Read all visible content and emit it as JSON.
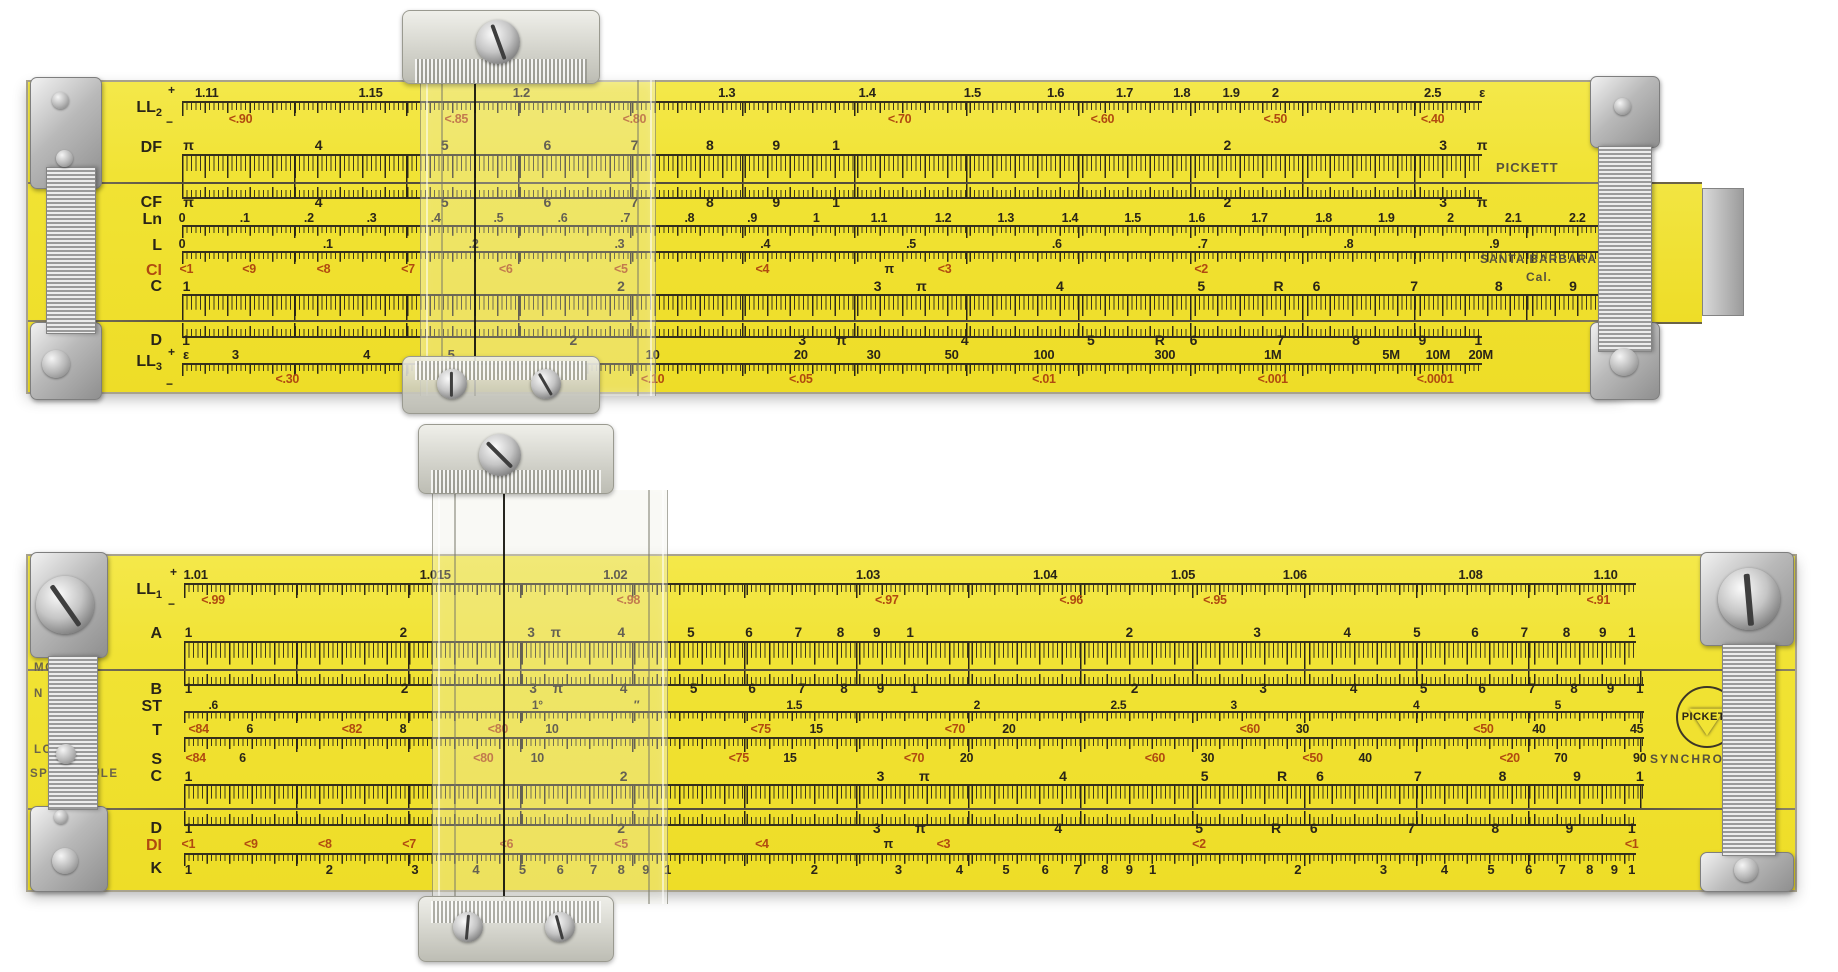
{
  "front": {
    "maker": "PICKETT",
    "city": "SANTA BARBARA",
    "state": "Cal.",
    "geom": {
      "trackX": 154,
      "statorW": 1300,
      "slideW": 1458,
      "bodyW": 1594
    },
    "scales": [
      {
        "label": "LL2",
        "lc": "k",
        "y": 4,
        "ldy": 14,
        "pm": [
          "+",
          "−"
        ],
        "parts": [
          [
            "n",
            0,
            16,
            "k",
            "LL2B",
            13
          ],
          [
            "t",
            15,
            13,
            "down"
          ],
          [
            "n",
            27,
            14,
            "r",
            "LL2R",
            12.5
          ]
        ]
      },
      {
        "label": "DF",
        "lc": "k",
        "y": 56,
        "ldy": 2,
        "parts": [
          [
            "n",
            0,
            17,
            "k",
            "DFCF",
            14
          ],
          [
            "t",
            16,
            28,
            "down"
          ]
        ]
      },
      {
        "seam": 100
      },
      {
        "label": "CF",
        "lc": "k",
        "y": 102,
        "ldy": 11,
        "parts": [
          [
            "t",
            0,
            13,
            "up"
          ],
          [
            "n",
            11,
            16,
            "k",
            "DFCF",
            14
          ]
        ]
      },
      {
        "label": "Ln",
        "lc": "k",
        "y": 130,
        "ldy": 0,
        "s": "slide",
        "parts": [
          [
            "n",
            0,
            14,
            "k",
            "LN",
            12.5
          ],
          [
            "t",
            13,
            11,
            "down"
          ]
        ]
      },
      {
        "label": "L",
        "lc": "k",
        "y": 156,
        "ldy": 0,
        "s": "slide",
        "parts": [
          [
            "n",
            0,
            14,
            "k",
            "LSC",
            12.5
          ],
          [
            "t",
            13,
            11,
            "down"
          ]
        ]
      },
      {
        "label": "CI",
        "lc": "r",
        "y": 181,
        "ldy": 0,
        "s": "slide",
        "parts": [
          [
            "n",
            0,
            14,
            "r",
            "CI",
            12.5
          ]
        ]
      },
      {
        "label": "C",
        "lc": "k",
        "y": 197,
        "ldy": 0,
        "s": "slide",
        "parts": [
          [
            "n",
            0,
            16,
            "k",
            "CD",
            14
          ],
          [
            "t",
            15,
            25,
            "down"
          ]
        ]
      },
      {
        "seam": 238
      },
      {
        "label": "D",
        "lc": "k",
        "y": 241,
        "ldy": 10,
        "parts": [
          [
            "t",
            0,
            13,
            "up"
          ],
          [
            "n",
            10,
            16,
            "k",
            "CD",
            14
          ]
        ]
      },
      {
        "label": "LL3",
        "lc": "k",
        "y": 266,
        "ldy": 6,
        "pm": [
          "+",
          "−"
        ],
        "parts": [
          [
            "n",
            0,
            16,
            "k",
            "LL3B",
            13
          ],
          [
            "t",
            15,
            11,
            "down"
          ],
          [
            "n",
            25,
            15,
            "r",
            "LL3R",
            12.5
          ]
        ]
      }
    ]
  },
  "back": {
    "logo_maker": "PICKETT",
    "tagline": "SYNCHRO",
    "model": [
      "MODEL",
      "N 803-ES",
      "LOG LOG",
      "SPEED RULE"
    ],
    "geom": {
      "trackX": 156,
      "statorW": 1452,
      "slideW": 1460,
      "bodyW": 1767
    },
    "scales": [
      {
        "label": "LL1",
        "lc": "k",
        "y": 12,
        "ldy": 14,
        "pm": [
          "+",
          "−"
        ],
        "parts": [
          [
            "n",
            0,
            16,
            "k",
            "LL1B",
            13
          ],
          [
            "t",
            15,
            13,
            "down"
          ],
          [
            "n",
            26,
            14,
            "r",
            "LL1R",
            12.5
          ]
        ]
      },
      {
        "label": "A",
        "lc": "k",
        "y": 70,
        "ldy": 0,
        "parts": [
          [
            "n",
            0,
            16,
            "k",
            "AB",
            13.5
          ],
          [
            "t",
            15,
            27,
            "down"
          ]
        ]
      },
      {
        "seam": 113
      },
      {
        "label": "B",
        "lc": "k",
        "y": 115,
        "ldy": 11,
        "s": "slide",
        "parts": [
          [
            "t",
            0,
            13,
            "up"
          ],
          [
            "n",
            11,
            16,
            "k",
            "AB",
            13.5
          ]
        ]
      },
      {
        "label": "ST",
        "lc": "k",
        "y": 143,
        "ldy": 0,
        "s": "slide",
        "parts": [
          [
            "n",
            0,
            13,
            "k",
            "ST",
            12
          ],
          [
            "t",
            12,
            10,
            "down"
          ]
        ]
      },
      {
        "label": "T",
        "lc": "k",
        "y": 167,
        "ldy": 0,
        "s": "slide",
        "parts": [
          [
            "n",
            0,
            15,
            "k",
            "T",
            12.5
          ],
          [
            "t",
            14,
            13,
            "down"
          ]
        ]
      },
      {
        "label": "S",
        "lc": "k",
        "y": 196,
        "ldy": 0,
        "s": "slide",
        "parts": [
          [
            "n",
            0,
            15,
            "k",
            "S",
            12.5
          ]
        ]
      },
      {
        "label": "C",
        "lc": "k",
        "y": 213,
        "ldy": 0,
        "s": "slide",
        "parts": [
          [
            "n",
            0,
            16,
            "k",
            "CD",
            14
          ],
          [
            "t",
            15,
            23,
            "down"
          ]
        ]
      },
      {
        "seam": 252
      },
      {
        "label": "D",
        "lc": "k",
        "y": 255,
        "ldy": 10,
        "parts": [
          [
            "t",
            0,
            13,
            "up"
          ],
          [
            "n",
            10,
            16,
            "k",
            "CD",
            14
          ]
        ]
      },
      {
        "label": "DI",
        "lc": "r",
        "y": 282,
        "ldy": 0,
        "parts": [
          [
            "n",
            0,
            14,
            "r",
            "CI",
            12.5
          ]
        ]
      },
      {
        "label": "K",
        "lc": "k",
        "y": 297,
        "ldy": 8,
        "parts": [
          [
            "t",
            0,
            11,
            "down"
          ],
          [
            "n",
            10,
            16,
            "k",
            "K",
            13
          ]
        ]
      }
    ]
  },
  "series": {
    "LL2B": [
      [
        "1.11",
        1.9
      ],
      [
        "1.15",
        14.5
      ],
      [
        "1.2",
        26.1
      ],
      [
        "1.3",
        41.9
      ],
      [
        "1.4",
        52.7
      ],
      [
        "1.5",
        60.8
      ],
      [
        "1.6",
        67.2
      ],
      [
        "1.7",
        72.5
      ],
      [
        "1.8",
        76.9
      ],
      [
        "1.9",
        80.7
      ],
      [
        "2",
        84.1
      ],
      [
        "2.5",
        96.2
      ],
      [
        "ε",
        100
      ]
    ],
    "LL2R": [
      [
        "<.90",
        4.5
      ],
      [
        "<.85",
        21.1
      ],
      [
        "<.80",
        34.8
      ],
      [
        "<.70",
        55.2
      ],
      [
        "<.60",
        70.8
      ],
      [
        "<.50",
        84.1
      ],
      [
        "<.40",
        96.2
      ]
    ],
    "DFCF": [
      [
        "π",
        0.5
      ],
      [
        "4",
        10.5
      ],
      [
        "5",
        20.2
      ],
      [
        "6",
        28.1
      ],
      [
        "7",
        34.8
      ],
      [
        "8",
        40.6
      ],
      [
        "9",
        45.7
      ],
      [
        "1",
        50.3
      ],
      [
        "2",
        80.4
      ],
      [
        "3",
        97
      ],
      [
        "π",
        100
      ]
    ],
    "LN": [
      [
        "0",
        0
      ],
      [
        ".1",
        4.3
      ],
      [
        ".2",
        8.7
      ],
      [
        ".3",
        13
      ],
      [
        ".4",
        17.4
      ],
      [
        ".5",
        21.7
      ],
      [
        ".6",
        26.1
      ],
      [
        ".7",
        30.4
      ],
      [
        ".8",
        34.8
      ],
      [
        ".9",
        39.1
      ],
      [
        "1",
        43.5
      ],
      [
        "1.1",
        47.8
      ],
      [
        "1.2",
        52.2
      ],
      [
        "1.3",
        56.5
      ],
      [
        "1.4",
        60.9
      ],
      [
        "1.5",
        65.2
      ],
      [
        "1.6",
        69.6
      ],
      [
        "1.7",
        73.9
      ],
      [
        "1.8",
        78.3
      ],
      [
        "1.9",
        82.6
      ],
      [
        "2",
        87
      ],
      [
        "2.1",
        91.3
      ],
      [
        "2.2",
        95.7
      ],
      [
        "2.3",
        100
      ]
    ],
    "LSC": [
      [
        "0",
        0
      ],
      [
        ".1",
        10
      ],
      [
        ".2",
        20
      ],
      [
        ".3",
        30
      ],
      [
        ".4",
        40
      ],
      [
        ".5",
        50
      ],
      [
        ".6",
        60
      ],
      [
        ".7",
        70
      ],
      [
        ".8",
        80
      ],
      [
        ".9",
        90
      ],
      [
        "1",
        100
      ]
    ],
    "CI": [
      [
        "<1",
        0.3
      ],
      [
        "<9",
        4.6
      ],
      [
        "<8",
        9.7
      ],
      [
        "<7",
        15.5
      ],
      [
        "<6",
        22.2
      ],
      [
        "<5",
        30.1
      ],
      [
        "<4",
        39.8
      ],
      [
        "π",
        48.5,
        "k"
      ],
      [
        "<3",
        52.3
      ],
      [
        "<2",
        69.9
      ],
      [
        "<1",
        99.7
      ]
    ],
    "CD": [
      [
        "1",
        0.3
      ],
      [
        "2",
        30.1
      ],
      [
        "3",
        47.7
      ],
      [
        "π",
        50.7
      ],
      [
        "4",
        60.2
      ],
      [
        "5",
        69.9
      ],
      [
        "R",
        75.2
      ],
      [
        "6",
        77.8
      ],
      [
        "7",
        84.5
      ],
      [
        "8",
        90.3
      ],
      [
        "9",
        95.4
      ],
      [
        "1",
        99.7
      ]
    ],
    "LL3B": [
      [
        "ε",
        0.3
      ],
      [
        "3",
        4.1
      ],
      [
        "4",
        14.2
      ],
      [
        "5",
        20.7
      ],
      [
        "10",
        36.2
      ],
      [
        "20",
        47.6
      ],
      [
        "30",
        53.2
      ],
      [
        "50",
        59.2
      ],
      [
        "100",
        66.3
      ],
      [
        "300",
        75.6
      ],
      [
        "1M",
        83.9
      ],
      [
        "5M",
        93
      ],
      [
        "10M",
        96.6
      ],
      [
        "20M",
        99.9
      ]
    ],
    "LL3R": [
      [
        "<.30",
        8.1
      ],
      [
        "<.20",
        20.7
      ],
      [
        "<.10",
        36.2
      ],
      [
        "<.05",
        47.6
      ],
      [
        "<.01",
        66.3
      ],
      [
        "<.001",
        83.9
      ],
      [
        "<.0001",
        96.4
      ]
    ],
    "LL1B": [
      [
        "1.01",
        0.8
      ],
      [
        "1.015",
        17.3
      ],
      [
        "1.02",
        29.7
      ],
      [
        "1.03",
        47.1
      ],
      [
        "1.04",
        59.3
      ],
      [
        "1.05",
        68.8
      ],
      [
        "1.06",
        76.5
      ],
      [
        "1.08",
        88.6
      ],
      [
        "1.10",
        97.9
      ]
    ],
    "LL1R": [
      [
        "<.99",
        2
      ],
      [
        "<.98",
        30.6
      ],
      [
        "<.97",
        48.4
      ],
      [
        "<.96",
        61.1
      ],
      [
        "<.95",
        71
      ],
      [
        "<.91",
        97.4
      ]
    ],
    "AB": [
      [
        "1",
        0.3
      ],
      [
        "2",
        15.1
      ],
      [
        "3",
        23.9
      ],
      [
        "π",
        25.6
      ],
      [
        "4",
        30.1
      ],
      [
        "5",
        34.9
      ],
      [
        "6",
        38.9
      ],
      [
        "7",
        42.3
      ],
      [
        "8",
        45.2
      ],
      [
        "9",
        47.7
      ],
      [
        "1",
        50
      ],
      [
        "2",
        65.1
      ],
      [
        "3",
        73.9
      ],
      [
        "4",
        80.1
      ],
      [
        "5",
        84.9
      ],
      [
        "6",
        88.9
      ],
      [
        "7",
        92.3
      ],
      [
        "8",
        95.2
      ],
      [
        "9",
        97.7
      ],
      [
        "1",
        99.7
      ]
    ],
    "ST": [
      [
        ".6",
        2
      ],
      [
        "1°",
        24.2
      ],
      [
        "″",
        31
      ],
      [
        "1.5",
        41.8
      ],
      [
        "2",
        54.3
      ],
      [
        "2.5",
        64
      ],
      [
        "3",
        71.9
      ],
      [
        "4",
        84.4
      ],
      [
        "5",
        94.1
      ]
    ],
    "T": [
      [
        "<84",
        1,
        "r"
      ],
      [
        "6",
        4.5
      ],
      [
        "<82",
        11.5,
        "r"
      ],
      [
        "8",
        15
      ],
      [
        "<80",
        21.5,
        "r"
      ],
      [
        "10",
        25.2
      ],
      [
        "<75",
        39.5,
        "r"
      ],
      [
        "15",
        43.3
      ],
      [
        "<70",
        52.8,
        "r"
      ],
      [
        "20",
        56.5
      ],
      [
        "<60",
        73,
        "r"
      ],
      [
        "30",
        76.6
      ],
      [
        "<50",
        89,
        "r"
      ],
      [
        "40",
        92.8
      ],
      [
        "45",
        99.5
      ]
    ],
    "S": [
      [
        "<84",
        0.8,
        "r"
      ],
      [
        "6",
        4
      ],
      [
        "<80",
        20.5,
        "r"
      ],
      [
        "10",
        24.2
      ],
      [
        "<75",
        38,
        "r"
      ],
      [
        "15",
        41.5
      ],
      [
        "<70",
        50,
        "r"
      ],
      [
        "20",
        53.6
      ],
      [
        "<60",
        66.5,
        "r"
      ],
      [
        "30",
        70.1
      ],
      [
        "<50",
        77.3,
        "r"
      ],
      [
        "40",
        80.9
      ],
      [
        "<20",
        90.8,
        "r"
      ],
      [
        "70",
        94.3
      ],
      [
        "90",
        99.7
      ]
    ],
    "K": [
      [
        "1",
        0.3
      ],
      [
        "2",
        10
      ],
      [
        "3",
        15.9
      ],
      [
        "4",
        20.1
      ],
      [
        "5",
        23.3
      ],
      [
        "6",
        25.9
      ],
      [
        "7",
        28.2
      ],
      [
        "8",
        30.1
      ],
      [
        "9",
        31.8
      ],
      [
        "1",
        33.3
      ],
      [
        "2",
        43.4
      ],
      [
        "3",
        49.2
      ],
      [
        "4",
        53.4
      ],
      [
        "5",
        56.6
      ],
      [
        "6",
        59.3
      ],
      [
        "7",
        61.5
      ],
      [
        "8",
        63.4
      ],
      [
        "9",
        65.1
      ],
      [
        "1",
        66.7
      ],
      [
        "2",
        76.7
      ],
      [
        "3",
        82.6
      ],
      [
        "4",
        86.8
      ],
      [
        "5",
        90
      ],
      [
        "6",
        92.6
      ],
      [
        "7",
        94.9
      ],
      [
        "8",
        96.8
      ],
      [
        "9",
        98.5
      ],
      [
        "1",
        99.7
      ]
    ]
  },
  "colors": {
    "body": "#f1e334",
    "marks": "#2a2517",
    "red": "#b04a10"
  }
}
